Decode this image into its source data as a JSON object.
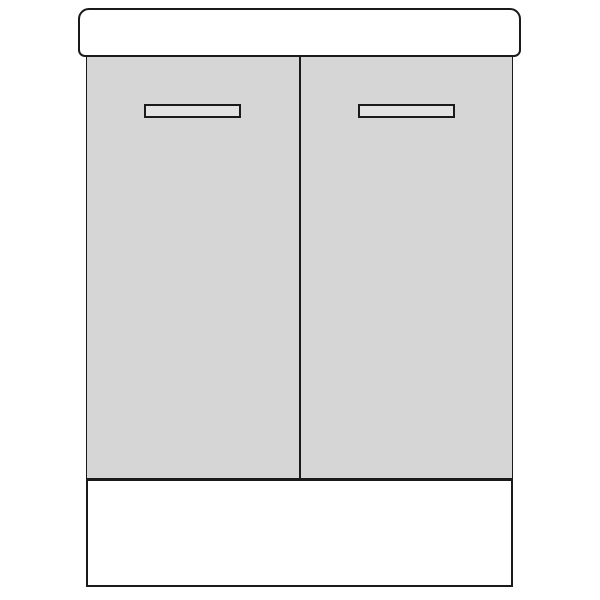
{
  "illustration": {
    "subject": "bathroom vanity sink cabinet, front elevation line drawing",
    "parts": {
      "countertop": "countertop-top-panel",
      "left_door": "left-cabinet-door",
      "right_door": "right-cabinet-door",
      "left_handle": "left-door-handle",
      "right_handle": "right-door-handle",
      "plinth": "base-plinth-panel"
    }
  },
  "colors": {
    "background": "#ffffff",
    "outline": "#1a1a1a",
    "panel_fill": "#ffffff",
    "door_fill": "#d6d6d6",
    "handle_fill": "#e3e3e3"
  }
}
